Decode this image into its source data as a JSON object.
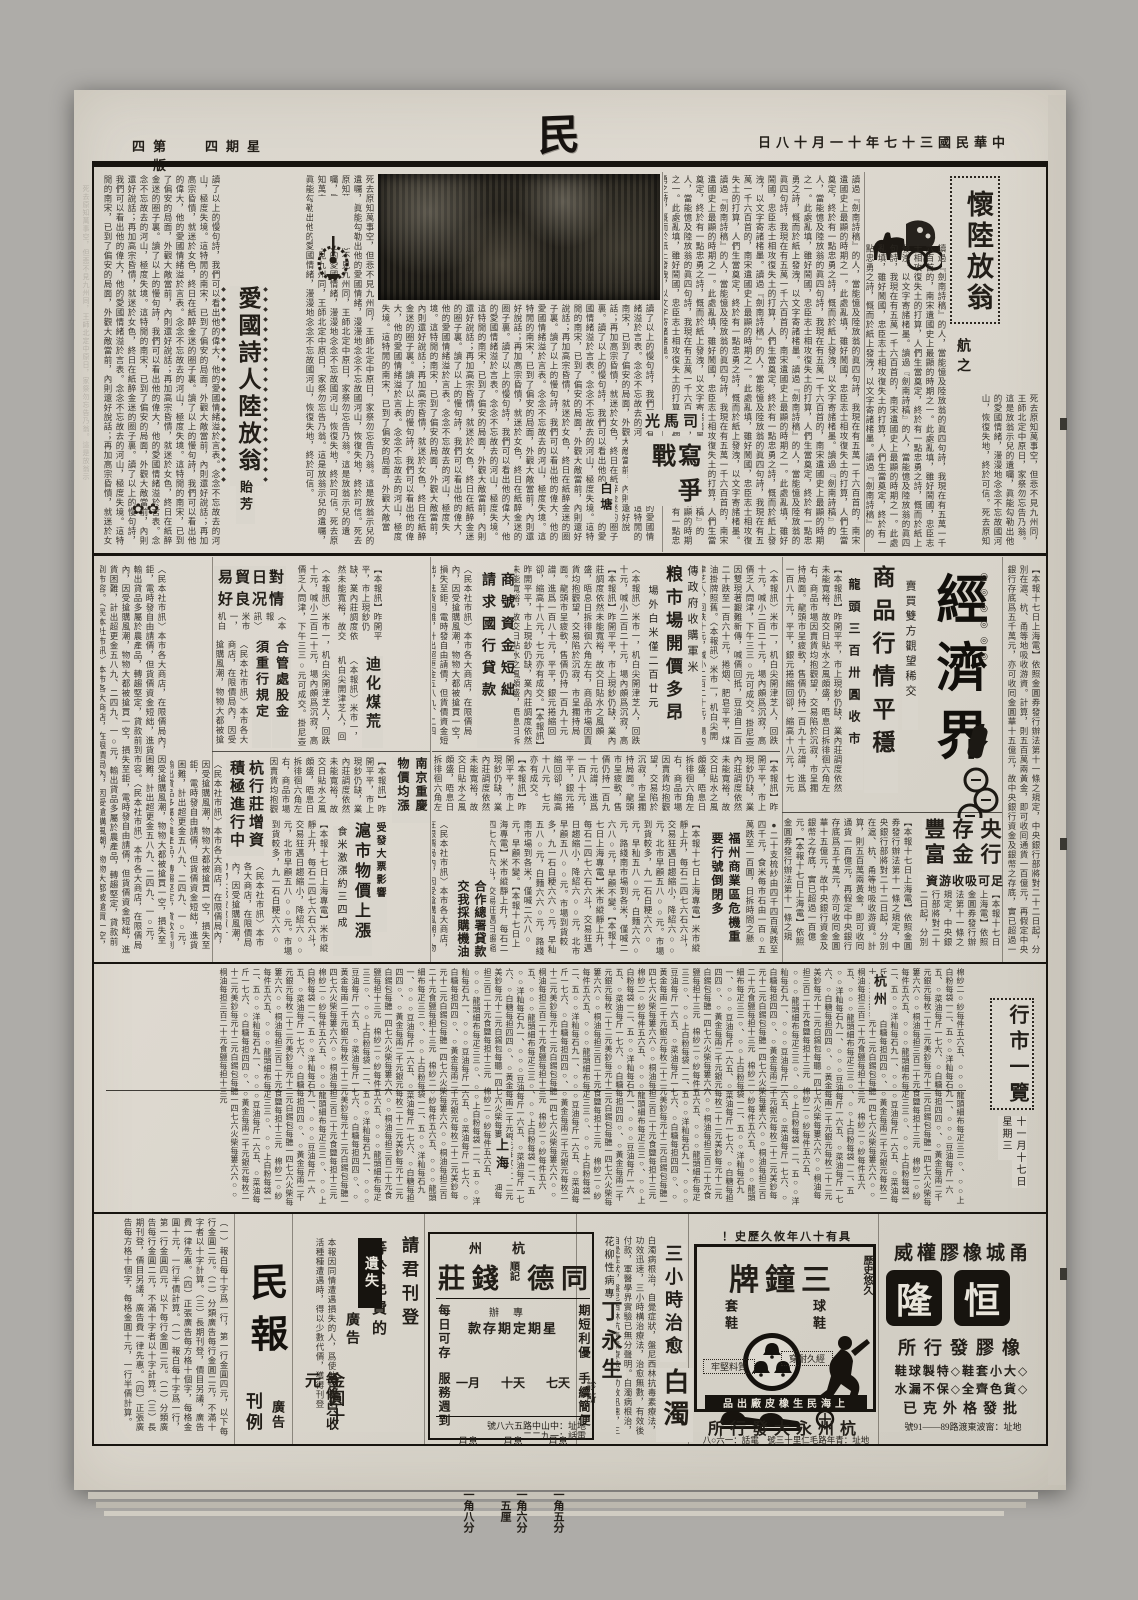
{
  "header": {
    "edition": "第四版",
    "weekday": "星期四",
    "masthead": "民報",
    "date": "中華民國三十七年十一月十八日"
  },
  "literary": {
    "huailu_title": "懷陸放翁",
    "huailu_author": "航之",
    "aiguo_title": "愛國詩人陸放翁",
    "aiguo_author": "貽芳",
    "sima_kicker": "司馬光",
    "sima_title": "寫戰爭",
    "sima_author": "白塘"
  },
  "economy": {
    "section": "經濟界",
    "lead_kicker": "賣買雙方觀望稀交",
    "lead_title": "商品行情平穩",
    "lead_sub": "龍頭三百卅圓收市",
    "grain_kicker": "傳政府收購軍米",
    "grain_title": "粮市場開價多昂",
    "grain_sub": "場外白米僅二百廿元",
    "loan_t1": "商號資金短絀",
    "loan_t2": "請求國行貸款",
    "japan_l1": "對日貿易",
    "japan_l2": "情况良好",
    "heguan_t1": "合管處股金",
    "heguan_t2": "須重行規定",
    "dihua": "迪化煤荒",
    "nanjing": "南京重慶物價均漲",
    "hangzhuang": "杭行莊增資積極進行中",
    "hu_kicker": "受發大票影響",
    "hu_title": "滬市物價上漲",
    "hu_sub": "食米激漲約三四成",
    "central_title": "央行存金豐富",
    "central_sub": "足可吸收游資",
    "fuzhou": "福州商業區危機重要行號倒閉多",
    "coop": "合作總署貸款交我採購機油"
  },
  "market": {
    "title": "行市一覽",
    "date": "十一月十七日",
    "weekday2": "星期三",
    "label_hangzhou": "杭州",
    "label_shanghai": "上海"
  },
  "ads": {
    "rates_big": "民報",
    "rates_small1": "廣告",
    "rates_small2": "刊例",
    "lost_l1": "請君刊登",
    "lost_l2": "等於免費的",
    "lost_l3a": "遺失",
    "lost_l3b": "廣告",
    "lost_l4": "每條只收",
    "lost_l5": "金圓十元",
    "td_city": "杭州",
    "td_n1": "同",
    "td_n2": "德",
    "td_small": "順記",
    "td_n3": "錢",
    "td_n4": "莊",
    "td_r1": "期短利優",
    "td_r2": "手續簡便",
    "td_l1": "每日可存",
    "td_l2": "服務週到",
    "td_h1": "專辦",
    "td_h2": "星期定期存款",
    "td_terms": [
      {
        "t": "七天",
        "i": "月息",
        "r": "一角五分"
      },
      {
        "t": "十天",
        "i": "月息",
        "r": "一角六分五厘"
      },
      {
        "t": "一月",
        "i": "月息",
        "r": "一角八分"
      }
    ],
    "td_addr": "地址：中山中路五六八號",
    "td_tel": "電話：一九二二",
    "ding_spec": "花柳性病專科醫師",
    "ding_name": "丁永生",
    "ding_clinic": "診所",
    "bz_t1": "三小時治愈",
    "bz_t2": "白濁",
    "zp_history": "具有十八年攸久歷史！",
    "zp_brand": "三鐘牌",
    "zp_corner": "歷史悠久",
    "zp_right": "球鞋",
    "zp_left": "套鞋",
    "zp_b1": "質料堅牢",
    "zp_b2": "經久耐穿",
    "zp_maker": "上海民生橡皮廠出品",
    "zp_dist": "杭州永大發行所",
    "zp_addr": "地址：青年路毛仁里十三號　電話：一六○八",
    "hl_kicker": "甬城橡膠權威",
    "hl_n1": "恒",
    "hl_n2": "隆",
    "hl_l1": "橡膠發行所",
    "hl_l2": "◇大小套鞋◇特製球鞋",
    "hl_l3": "◇貨色齊全◇保不漏水",
    "hl_l4": "批發格外克已",
    "hl_addr_display": "號91——89路渡東波甯：址地"
  },
  "ornaments": {
    "diamonds": "◆◆◆◆◆◆◆◆◆◆◆◆◆◆◆◆◆◆◆◆",
    "rings": "◎◎◎◎◎◎",
    "flowers": "✿✿"
  },
  "filler": {
    "t1": "死去原知萬事空，但悲不見九州同，王師北定中原日，家祭勿忘告乃翁。這是放翁示兒的遺囑，眞能勾勒出他的愛國情緒，漫漫地念念不忘故國河山，恢復失地，終於可信。",
    "t2": "讀了以上的慢句詩，我們可以看出他的偉大，他的愛國情緒溢於言表。念念不忘故去的河山，極度失境。這特閒的南宋，已到了偏安的局面，外觀大敵當前，內則還好說話；再加高宗昏憒，就迷於女色，終日在紙醉金迷的圈子裏。",
    "t3": "【本報訊】昨開平平，市上現鈔仍缺，業內莊調度依然未能寬裕，故交日貼水之風頗盛，晤息日拆徘徊六角左右，商品市場因賣貨均抱觀望，交易陷於沉寂，市呈擱持局面。龍頭市呈疲軟，售價仍持一百九十元譜，進爲一百八十元，平平，銀元捲縮回卻，縮高十八元，七元亦有成交。",
    "t4": "〈本報訊〉米市一，机白尖開津芝人，回跌十元，喊小二百二十元，場內頗爲沉寂，高價乏人問津，下午三三○元可成交。掛尼壺因雙現著艱難新傳，喊價回抵，豆油自二百二十跌至一百六十元，捲烟、肥皂平平，煤油掛牌照舊。",
    "t5": "〈民本社市訊〉本市各大商店，在限價局內，因受搶購風潮，物物大都被搶買一空，損失至鉅，電時發自由請價，但貨價資金短絀，進貨困難，計出超更金五八九、二四九、一○元，輸出貸品多屬於農產品，轉趨堅定，貸款前到市容。",
    "t6": "棉紗二○紗每件五六五、○○○龍頭細布每疋三三○、○○上白粉每袋一二、五○○洋籼每石九一、○○○豆油每斤一六五、○菜油每斤一七六、○白糖每担四四○、○黃金每兩二千元銀元每枚二十二元美鈔每元十二元白錫包每聽一四七六火柴每簍六六○○桐油每担三百二十元食鹽每担十三元　",
    "t7": "（一）報白每十字爲一行，第一行金圓四元，以下每行金圓二元。（二）分類廣告每行金圓二元，不滿十字者以十字計算。（三）長期刊登，價目另議，廣告費一律先惠。（四）正張廣告每方格十個字，每格金圓十元，一行半價計算。",
    "t8": "【本報十七日上海電】依照金圓券發行辦法第十一條之規定，中央銀行部將對二十二日起，分別在滬、杭、甬等地吸收游資。計算，則五百萬兩黃金，即可收囘通貨一百億元，再假定中央銀行存底爲五千萬元，亦可收囘金圓華十五億元，故中央銀行資金及銀幣之存底，實已超過一百億元。",
    "t9": "【本報十七日上海專電】米市縱靜上升，每石二四七六石六斗，交易狂邁日趨縮小，降紹六○○元，北市早顧五八○○元。市場到貨較多，九一石白粳六六○元，早秈五八○元，白麵六六○元，路綫南市場到各米，僅喊二六八○元，早顧不變。",
    "t10": "●二十支梳紗由四千四百萬跌至四千元，食米每市石由一百○五萬跌至一百圓，日拆時間之懸定。黃金及銀幣絕緣監至一百億元，實已超過，故中央銀行資金及銀幣之擱備，緣蒸之慮，頗料今持市場可保持範相當。",
    "t11": "讀過『劍南詩稿』的人，當能憶及陸放翁的眞四句詩，我現在有五萬一千六百首的，南宋遺國史上最顯的時期之一。此處亂填，雖好鬧國，忠臣志士相攻復失土的打算，人們生當奠定，終於有一點忠勇之詩，慨而於紙上發洩，以文字寄諸楮墨。",
    "lost": "本報因同情遭遇損失的人，爲使他們在生活種種遭遇時，得以少數代價，獲得刊登等於免費的小廣告的機會，特定每條每天祇收紙本金圓十元，但以三行爲限。",
    "bai": "白濁病根治，自覺症狀，盤尼西林抗毒素療法，功效迅速，三小時構治療法，治愈無數，有效後付款，軍醫學界實驗已無分聲明。"
  }
}
